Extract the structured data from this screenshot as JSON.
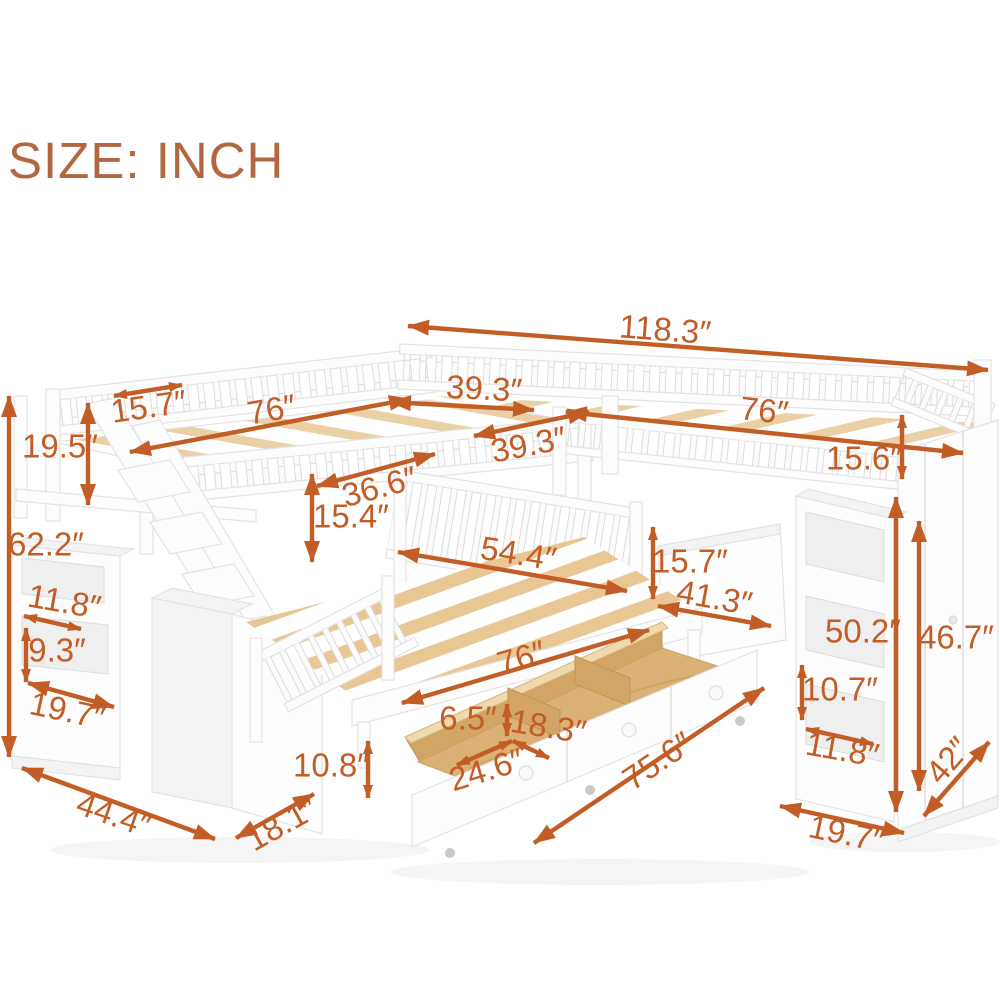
{
  "title": "SIZE: INCH",
  "colors": {
    "accent": "#c25d26",
    "title": "#b26740",
    "slat_wood": "#ecd0a5",
    "drawer_wood": "#dcb177",
    "furniture_white": "#fdfdfd"
  },
  "dims": {
    "overall_width": "118.3″",
    "top_left_depth": "15.7″",
    "left_bed_length": "76″",
    "left_bed_width": "39.3″",
    "right_bed_width": "39.3″",
    "right_bed_length": "76″",
    "right_rail_height": "15.6″",
    "guardrail_height": "19.5″",
    "overall_height": "62.2″",
    "corner_width": "36.6″",
    "upper_clearance": "15.4″",
    "lower_bed_width": "54.4″",
    "lower_bed_length": "76″",
    "stair_shelf_width": "11.8″",
    "stair_shelf_height": "9.3″",
    "stair_shelf_depth": "19.7″",
    "staircase_length": "44.4″",
    "staircase_depth": "18.1″",
    "under_bed_height": "10.8″",
    "drawer_height": "6.5″",
    "drawer_depth": "18.3″",
    "drawer_width": "24.6″",
    "drawers_length": "75.6″",
    "headboard_height": "15.7″",
    "headboard_width": "41.3″",
    "shelf_height": "50.2″",
    "wardrobe_height": "46.7″",
    "cubby_height": "10.7″",
    "cubby_width": "11.8″",
    "wardrobe_depth": "42″",
    "wardrobe_width": "19.7″"
  }
}
